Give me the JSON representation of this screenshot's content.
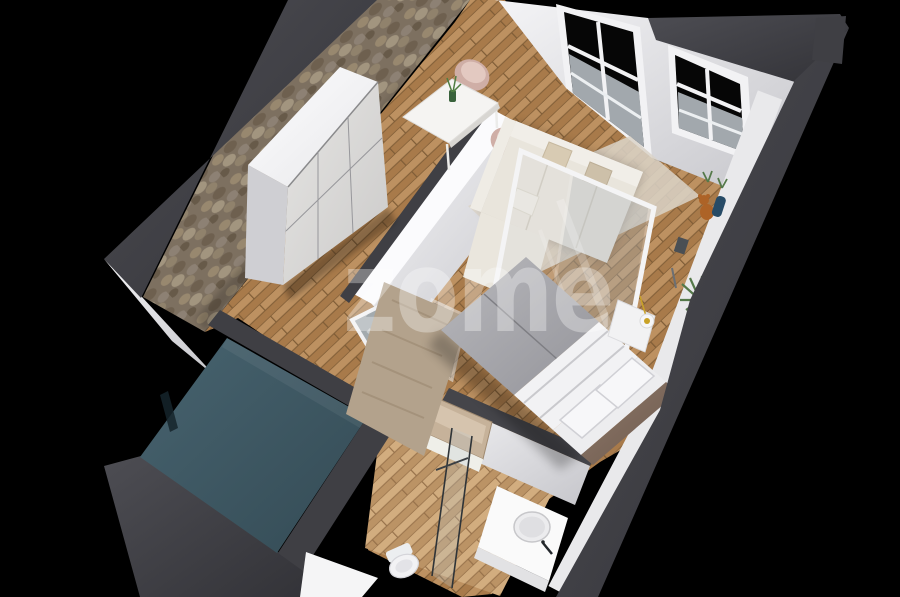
{
  "watermark": {
    "text": "zome",
    "color": "#ffffff",
    "opacity": "0.32"
  },
  "palette": {
    "background": "#000000",
    "wall-cut": "#3f3f44",
    "wall-white": "#ededef",
    "stone": "#7d7060",
    "wood": "#b28252",
    "wood-light": "#c8a172",
    "teal-slab": "#3d5561",
    "sofa": "#e9e5dc",
    "bed-duvet": "#a6a6aa",
    "bed-linen": "#f2f2f4",
    "headboard": "#86705f",
    "chair-blush": "#cfaea6",
    "rug-living": "#dbd4c8",
    "rug-bedroom": "#b3a28c",
    "plant-green": "#55794a",
    "teddy-orange": "#ad6327",
    "accent-blue": "#274b66",
    "glass-tint": "#cdd4d8",
    "wm": "#ffffff"
  }
}
